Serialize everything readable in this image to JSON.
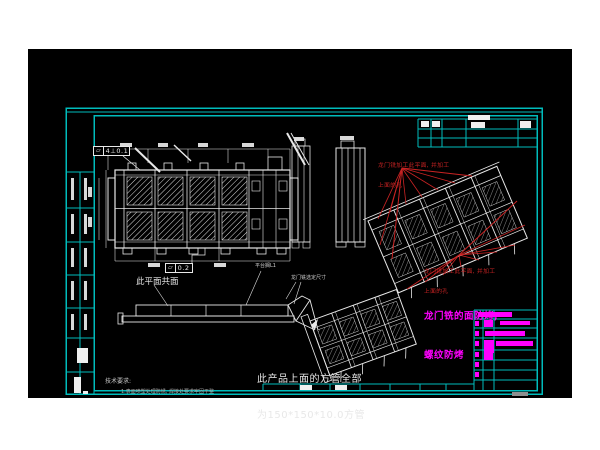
{
  "colors": {
    "background": "#000000",
    "sheet_frame": "#00bcbc",
    "linework": "#e8e8e8",
    "annotation_red": "#c92323",
    "note_magenta": "#ff00ff"
  },
  "notes": {
    "red_machining_note": {
      "line1": "龙门铣加工此平面, 并加工",
      "line2": "上面的孔"
    },
    "magenta_note": {
      "line1": "龙门铣的面防烤,",
      "line2": "螺纹防烤"
    },
    "coplanar_label": "此平面共面",
    "platform_label": "平台搁L1",
    "gantry_dim_label": "龙门铣选定尺寸",
    "product_note": {
      "line1": "此产品上面的方管全部",
      "line2": "为150*150*10.0方管"
    },
    "tech_req": {
      "title": "技术要求:",
      "item1": "1.表面喷塑处理防锈, 焊接处要求牢固平整"
    },
    "tolerance_frame_1": "4⊥0.1",
    "tolerance_frame_2": "0.2",
    "flatness_symbol": "▱"
  }
}
